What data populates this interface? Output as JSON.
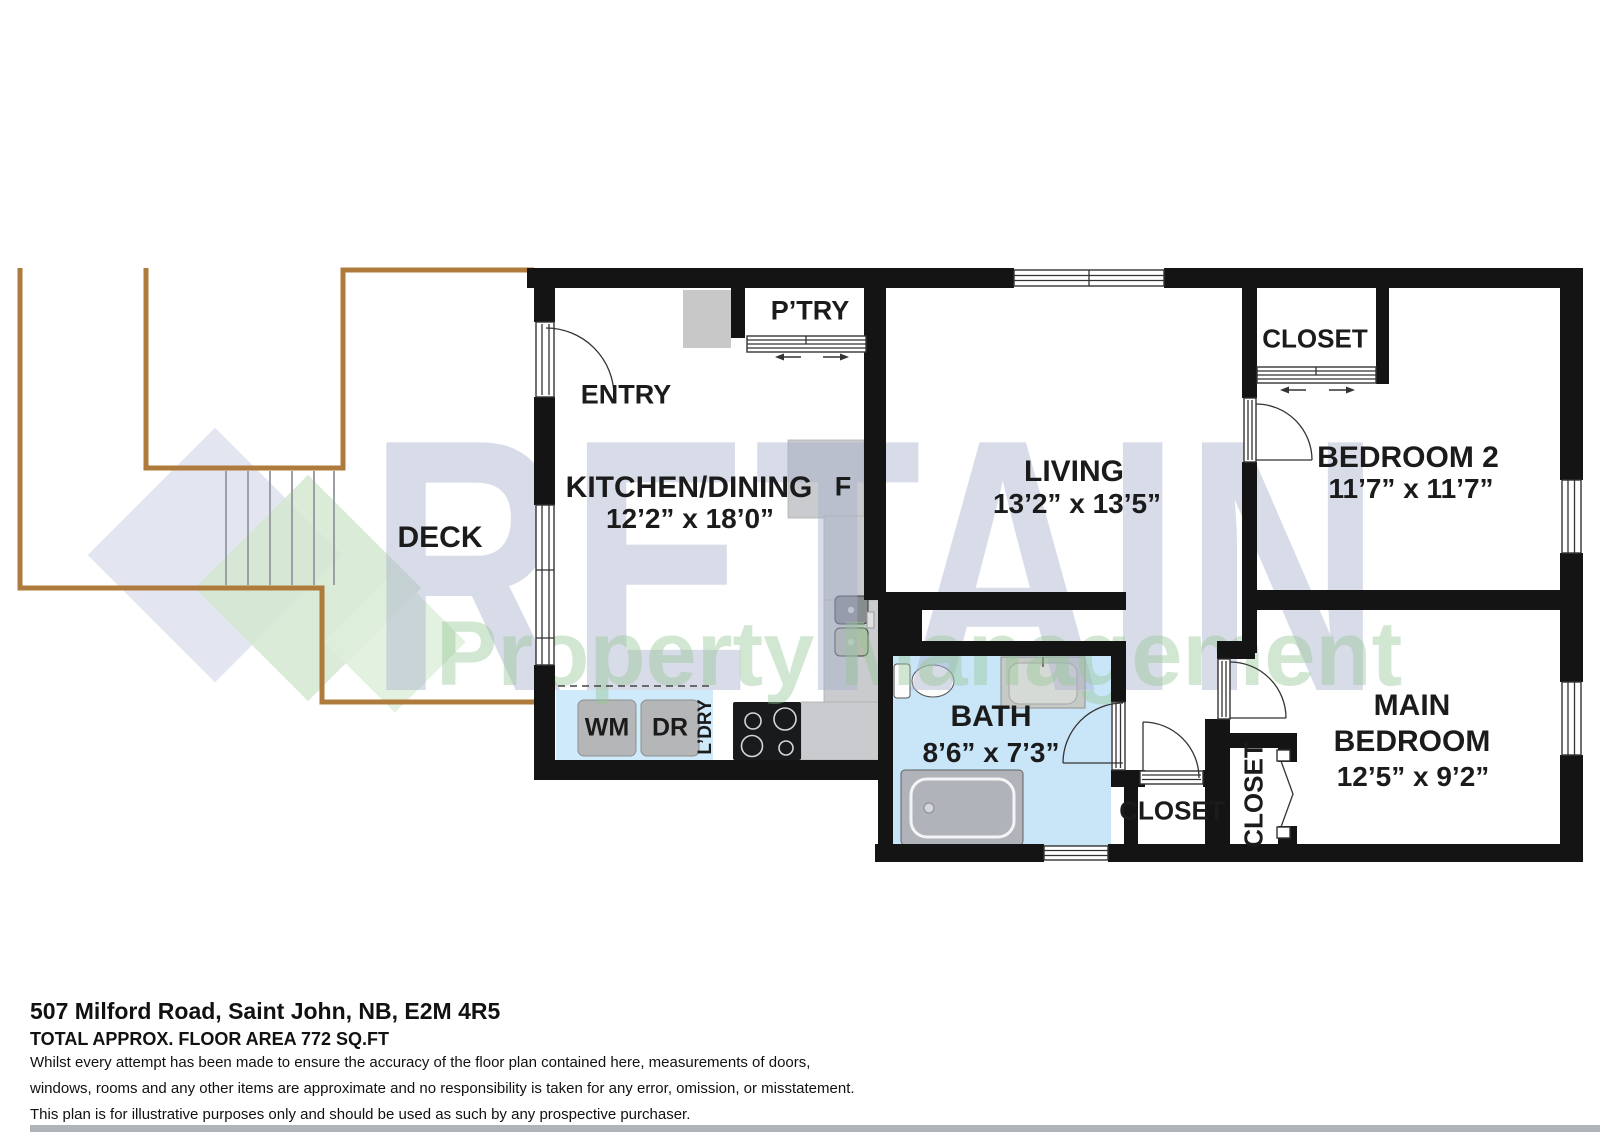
{
  "colors": {
    "wall": "#141414",
    "deck": "#ae7b3c",
    "bath_floor": "#c9e5f8",
    "laundry_floor": "#cfeafa",
    "watermark_blue": "#aab1cd",
    "watermark_green": "#96c894",
    "label": "#1b1b1b"
  },
  "watermark": {
    "title": "RETAIN",
    "subtitle": "Property Management"
  },
  "rooms": {
    "deck": {
      "label": "DECK"
    },
    "entry": {
      "label": "ENTRY"
    },
    "kitchen": {
      "label": "KITCHEN/DINING",
      "dims": "12’2” x 18’0”"
    },
    "pantry": {
      "label": "P’TRY"
    },
    "fridge": {
      "label": "F"
    },
    "living": {
      "label": "LIVING",
      "dims": "13’2” x 13’5”"
    },
    "closet_bed2": {
      "label": "CLOSET"
    },
    "bedroom2": {
      "label": "BEDROOM 2",
      "dims": "11’7” x 11’7”"
    },
    "bath": {
      "label": "BATH",
      "dims": "8’6” x 7’3”"
    },
    "closet_hall": {
      "label": "CLOSET"
    },
    "closet_main": {
      "label": "CLOSET"
    },
    "main_bedroom": {
      "label": "MAIN BEDROOM",
      "dims": "12’5” x 9’2”"
    },
    "laundry": {
      "washer": "WM",
      "dryer": "DR",
      "label": "L’DRY"
    }
  },
  "footer": {
    "address": "507 Milford Road, Saint John, NB, E2M 4R5",
    "area": "TOTAL APPROX. FLOOR AREA 772 SQ.FT",
    "disclaimer1": "Whilst every attempt has been made to ensure the accuracy of the floor plan contained here, measurements of doors,",
    "disclaimer2": "windows, rooms and any other items are approximate and no responsibility is taken for any error, omission, or misstatement.",
    "disclaimer3": "This plan is for illustrative purposes only and should be used as such by any prospective purchaser."
  }
}
